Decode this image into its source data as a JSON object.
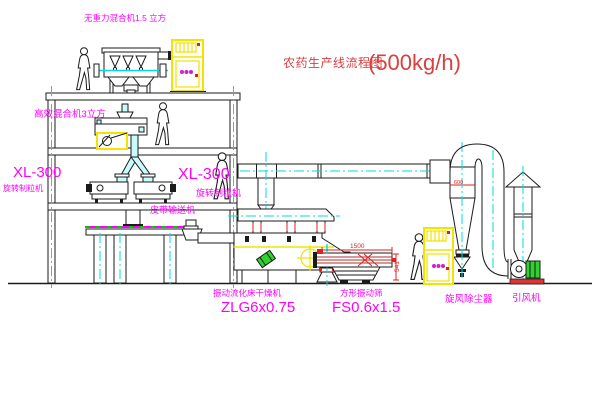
{
  "diagram": {
    "title": "农药生产线流程图",
    "capacity": "(500kg/h)"
  },
  "equipment_labels": {
    "gravity_free_mixer": "无重力混合机1.5 立方",
    "high_efficiency_mixer": "高效混合机3立方",
    "granulator_model_left": "XL-300",
    "granulator_left": "旋转制粒机",
    "granulator_model_right": "XL-300",
    "granulator_right": "旋转制粒机",
    "belt_conveyor": "皮带输送机",
    "fluid_bed_dryer": "振动流化床干燥机",
    "fluid_bed_dryer_model": "ZLG6x0.75",
    "vibrating_sieve": "方形振动筛",
    "vibrating_sieve_model": "FS0.6x1.5",
    "cyclone_dust_collector": "旋风除尘器",
    "induced_draft_fan": "引风机"
  },
  "dimensions": {
    "sieve_length": "1500",
    "sieve_height": "541",
    "cyclone_inlet": "600"
  },
  "colors": {
    "label_magenta": "#ff00ff",
    "title_red": "#d94040",
    "centerline_cyan": "#00dcdc",
    "cabinet_yellow": "#f0e400",
    "machine_green": "#2fd32f",
    "dimension_red": "#dd2222"
  }
}
